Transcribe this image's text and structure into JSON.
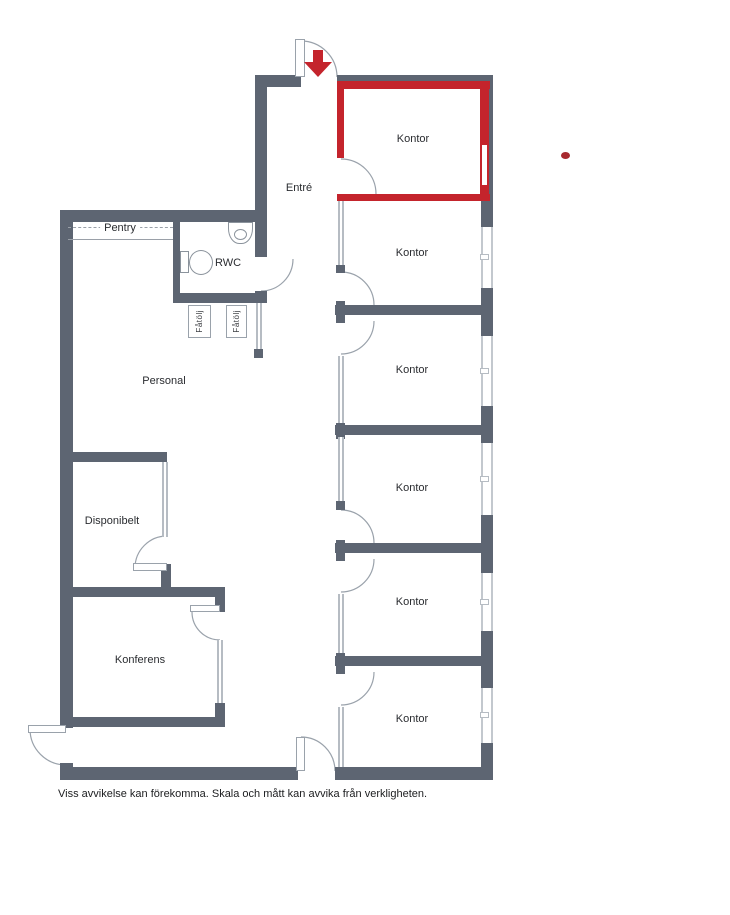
{
  "palette": {
    "wall": "#5d6572",
    "highlight_red": "#c4242c",
    "glass_partition": "#b6bcc3",
    "window": "#c3c8ce",
    "text": "#2a2c30"
  },
  "labels": {
    "entre": "Entré",
    "pentry": "Pentry",
    "rwc": "RWC",
    "personal": "Personal",
    "disponibelt": "Disponibelt",
    "konferens": "Konferens",
    "fatolj": [
      "Fåtölj",
      "Fåtölj"
    ],
    "offices": [
      "Kontor",
      "Kontor",
      "Kontor",
      "Kontor",
      "Kontor",
      "Kontor"
    ]
  },
  "highlight": {
    "room_label": "Kontor",
    "color": "#c4242c",
    "marker": "red-dot"
  },
  "icons": {
    "entrance_arrow": "down-arrow",
    "toilet": "toilet-symbol",
    "sink": "sink-symbol",
    "armchair": "armchair-symbol"
  },
  "caption": "Viss avvikelse kan förekomma. Skala och mått kan avvika från verkligheten."
}
